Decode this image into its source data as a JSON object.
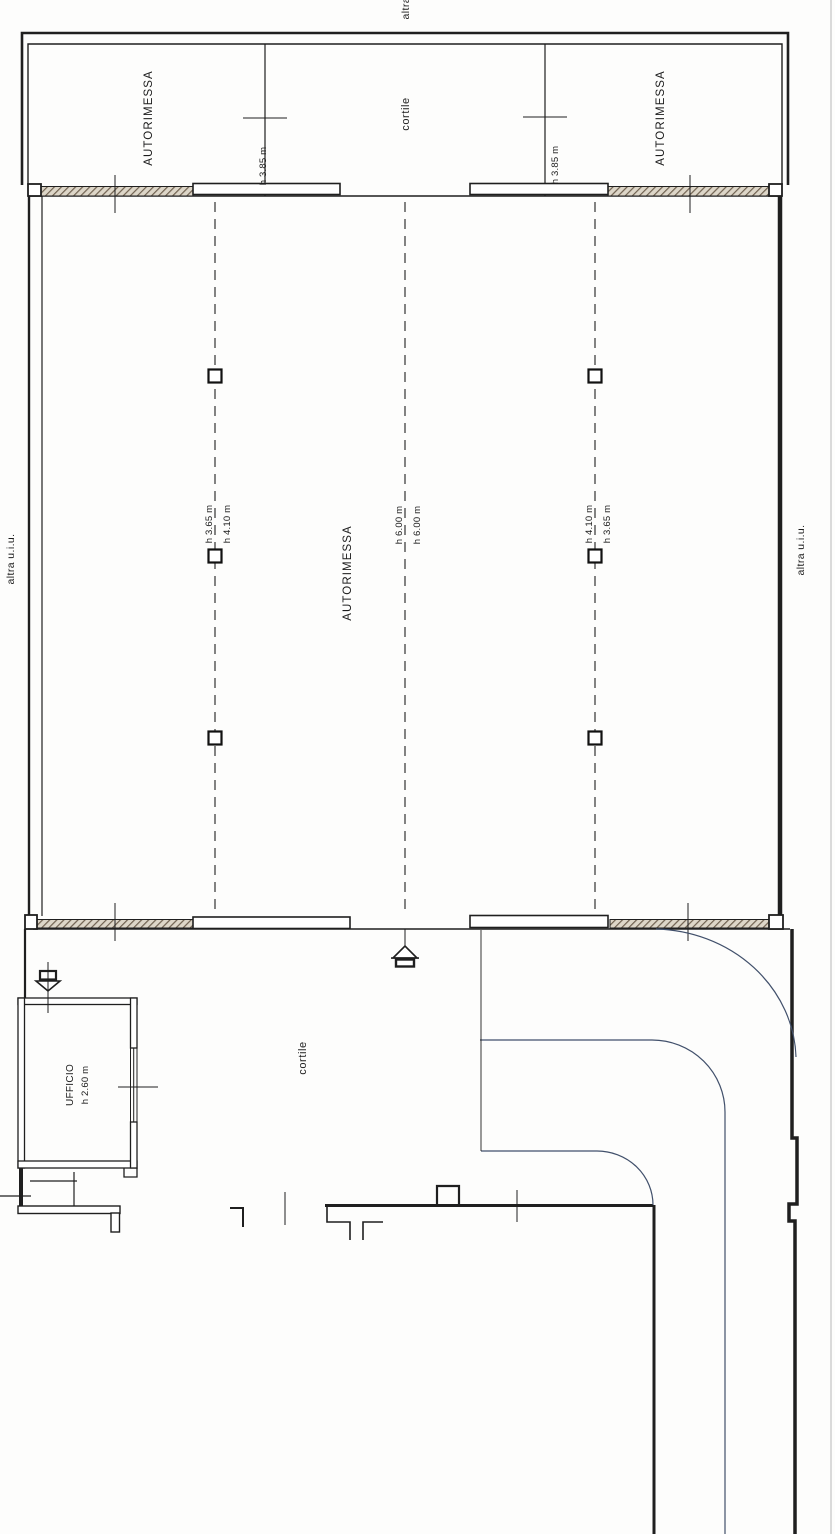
{
  "document": {
    "type": "floor-plan-scan",
    "drawing": "planimetria autorimessa"
  },
  "labels": {
    "adjacent_top": "altra u.i.u.",
    "adjacent_left": "altra u.i.u.",
    "adjacent_right": "altra u.i.u.",
    "garage_top_left": "AUTORIMESSA",
    "garage_top_right": "AUTORIMESSA",
    "courtyard_top": "cortile",
    "garage_main": "AUTORIMESSA",
    "courtyard_bottom": "cortile",
    "office_name": "UFFICIO",
    "office_height": "h 2.60 m",
    "height_top_left": "h 3.85 m",
    "height_top_right": "h 3.85 m",
    "height_left_a": "h 3.65 m",
    "height_left_b": "h 4.10 m",
    "height_center_a": "h 6.00 m",
    "height_center_b": "h 6.00 m",
    "height_right_a": "h 4.10 m",
    "height_right_b": "h 3.65 m"
  },
  "colors": {
    "ink": "#1f1f1f",
    "curve_line": "#41506b",
    "hatch": "#6f6150",
    "paper": "#fdfdfc"
  }
}
